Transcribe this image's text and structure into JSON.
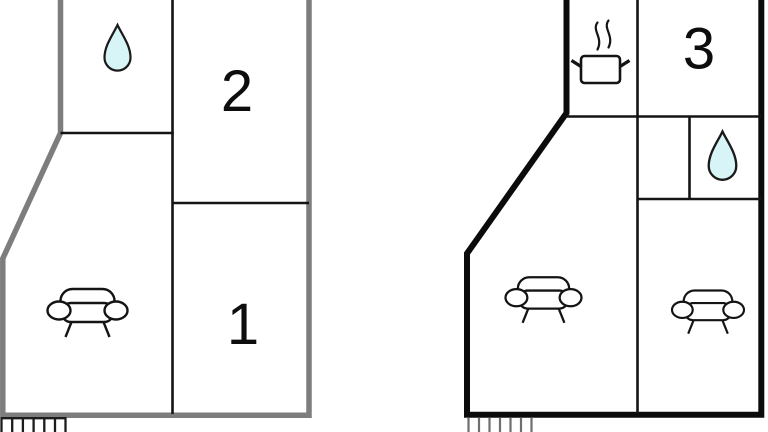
{
  "document": {
    "type": "floor-plan-drawing",
    "plan_count": 2
  },
  "plans": {
    "left": {
      "name": "floor-plan-left",
      "rooms": {
        "room2": {
          "number": "2"
        },
        "room1": {
          "number": "1"
        },
        "bathroom": {
          "icon": "water-drop"
        },
        "living": {
          "icon": "sofa"
        }
      }
    },
    "right": {
      "name": "floor-plan-right",
      "rooms": {
        "room3": {
          "number": "3"
        },
        "kitchen": {
          "icon": "cooking-pot"
        },
        "bathroom": {
          "icon": "water-drop"
        },
        "living_left": {
          "icon": "sofa"
        },
        "living_right": {
          "icon": "sofa"
        }
      }
    }
  },
  "colors": {
    "background": "#ffffff",
    "left_outer_wall": "#7d7d7d",
    "right_outer_wall": "#0b0b0b",
    "inner_wall": "#141414",
    "water_drop_fill": "#d7f4f6",
    "hatch_left": "#1c1c1c",
    "hatch_right": "#6f6f6f",
    "label_color": "#0d0d0d"
  }
}
